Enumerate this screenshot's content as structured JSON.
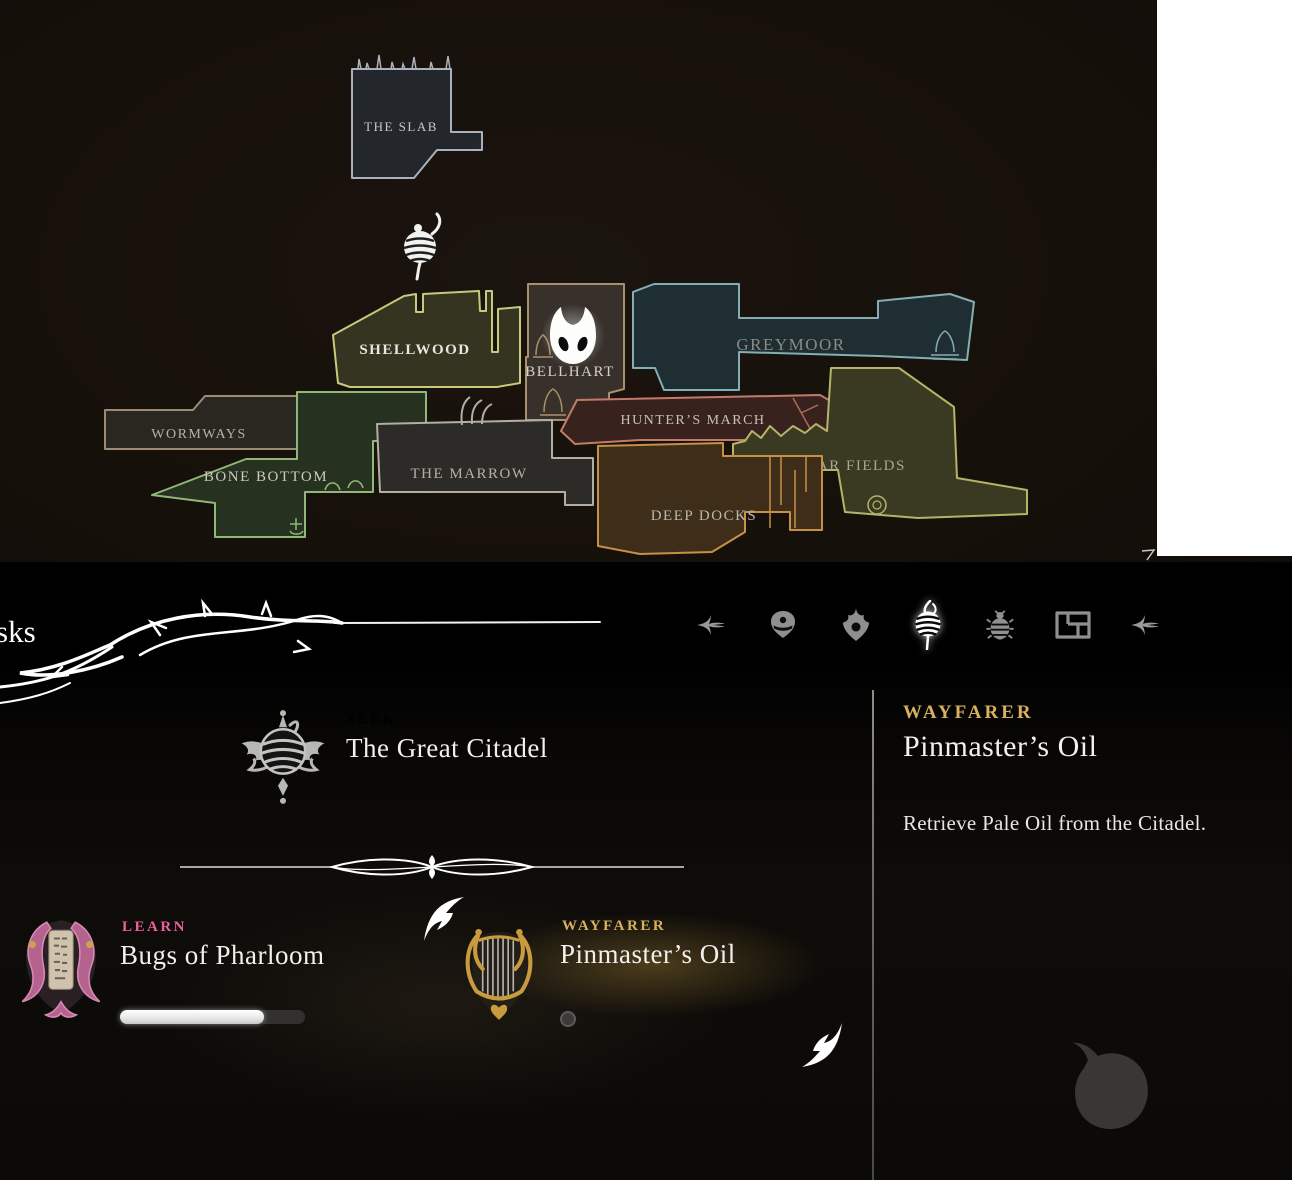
{
  "screen": "quest-journal",
  "header": {
    "title_fragment": "sks",
    "tabs": [
      {
        "label": "previous-section",
        "icon": "thorn-arrow-left-icon",
        "active": false
      },
      {
        "label": "inventory",
        "icon": "mask-icon",
        "active": false
      },
      {
        "label": "crests",
        "icon": "crest-icon",
        "active": false
      },
      {
        "label": "quests",
        "icon": "silk-spool-icon",
        "active": true
      },
      {
        "label": "bestiary",
        "icon": "bug-icon",
        "active": false
      },
      {
        "label": "maps",
        "icon": "map-fragment-icon",
        "active": false
      },
      {
        "label": "next-section",
        "icon": "thorn-arrow-right-icon",
        "active": false
      }
    ]
  },
  "map": {
    "regions": [
      {
        "label": "THE SLAB",
        "border_color": "#a9b2bc",
        "fill_color": "#23262b"
      },
      {
        "label": "SHELLWOOD",
        "border_color": "#c6ca7d",
        "fill_color": "#343420"
      },
      {
        "label": "BELLHART",
        "border_color": "#a8906a",
        "fill_color": "#38302a"
      },
      {
        "label": "GREYMOOR",
        "border_color": "#84aeb3",
        "fill_color": "#1e2e32"
      },
      {
        "label": "WORMWAYS",
        "border_color": "#9c8c74",
        "fill_color": "#2a2620"
      },
      {
        "label": "BONE BOTTOM",
        "border_color": "#8fb878",
        "fill_color": "#27311f"
      },
      {
        "label": "THE MARROW",
        "border_color": "#b2aea2",
        "fill_color": "#2d2b27"
      },
      {
        "label": "HUNTER’S MARCH",
        "border_color": "#c47a68",
        "fill_color": "#38221e"
      },
      {
        "label": "FAR FIELDS",
        "border_color": "#b5b468",
        "fill_color": "#3a3921"
      },
      {
        "label": "DEEP DOCKS",
        "border_color": "#c78f47",
        "fill_color": "#3e2e19"
      }
    ],
    "markers": [
      {
        "name": "player-mask-marker",
        "region": "BELLHART"
      },
      {
        "name": "silk-spool-marker",
        "region": "SHELLWOOD"
      }
    ]
  },
  "quests": {
    "items": [
      {
        "kicker": "SEEK",
        "kicker_color": "#8d8d86",
        "title": "The Great Citadel",
        "icon": "winged-spool-medal-icon",
        "selected": false
      },
      {
        "kicker": "LEARN",
        "kicker_color": "#ee5f9e",
        "title": "Bugs of Pharloom",
        "icon": "lyre-scroll-icon",
        "progress_percent": 78,
        "selected": false
      },
      {
        "kicker": "WAYFARER",
        "kicker_color": "#d8b15f",
        "title": "Pinmaster’s Oil",
        "icon": "gold-harp-icon",
        "selected": true
      }
    ]
  },
  "detail_panel": {
    "kicker": "WAYFARER",
    "kicker_color": "#d8b15f",
    "title": "Pinmaster’s Oil",
    "description": "Retrieve Pale Oil from the Citadel."
  }
}
